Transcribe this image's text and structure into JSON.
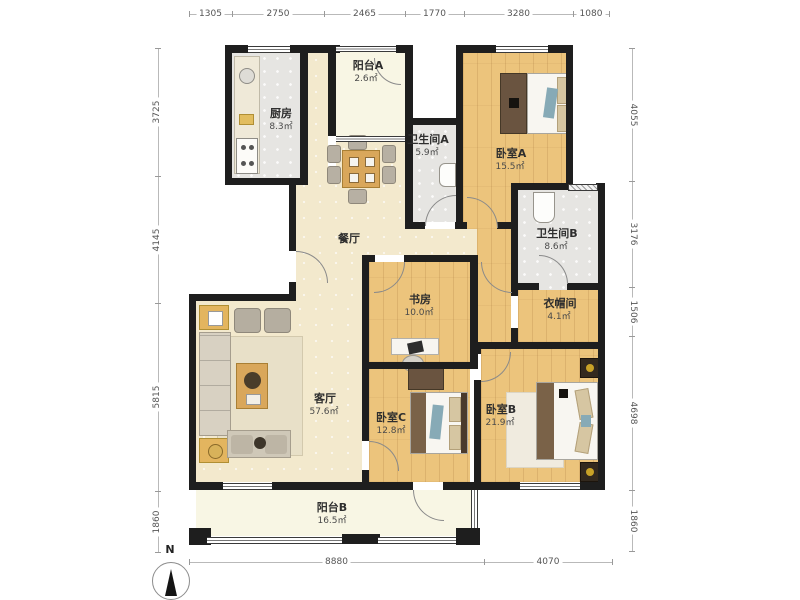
{
  "rooms": {
    "kitchen": {
      "name": "厨房",
      "area": "8.3㎡"
    },
    "balcony_a": {
      "name": "阳台A",
      "area": "2.6㎡"
    },
    "bath_a": {
      "name": "卫生间A",
      "area": "5.9㎡"
    },
    "bedroom_a": {
      "name": "卧室A",
      "area": "15.5㎡"
    },
    "bath_b": {
      "name": "卫生间B",
      "area": "8.6㎡"
    },
    "cloakroom": {
      "name": "衣帽间",
      "area": "4.1㎡"
    },
    "study": {
      "name": "书房",
      "area": "10.0㎡"
    },
    "dining": {
      "name": "餐厅"
    },
    "living": {
      "name": "客厅",
      "area": "57.6㎡"
    },
    "bedroom_c": {
      "name": "卧室C",
      "area": "12.8㎡"
    },
    "bedroom_b": {
      "name": "卧室B",
      "area": "21.9㎡"
    },
    "balcony_b": {
      "name": "阳台B",
      "area": "16.5㎡"
    }
  },
  "dimensions": {
    "top": [
      "1305",
      "2750",
      "2465",
      "1770",
      "3280",
      "1080"
    ],
    "left": [
      "3725",
      "4145",
      "5815",
      "1860"
    ],
    "right": [
      "4055",
      "3176",
      "1506",
      "4698",
      "1860"
    ],
    "bottom": [
      "8880",
      "4070"
    ]
  },
  "compass": {
    "north_label": "N"
  },
  "colors": {
    "wall": "#1e1e1e",
    "wood_floor": "#ecc47c",
    "tile_floor": "#e6e5e2",
    "living_floor": "#f3e9cd",
    "balcony_floor": "#f8f6e4"
  }
}
